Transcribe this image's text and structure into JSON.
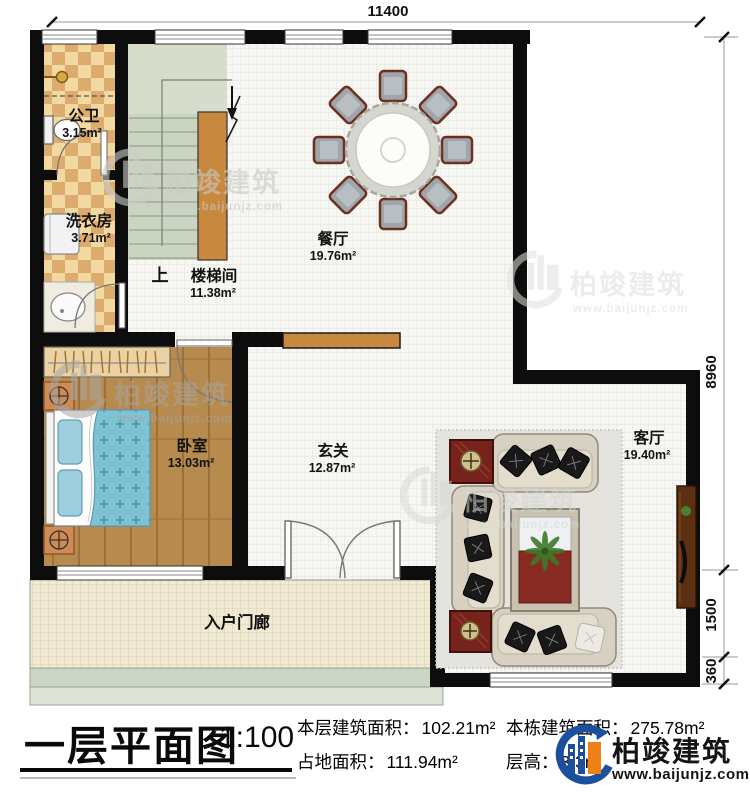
{
  "title_bar": {
    "plan_title": "一层平面图",
    "scale": "1:100",
    "stats": [
      {
        "label": "本层建筑面积：",
        "value": "102.21m²"
      },
      {
        "label": "占地面积：",
        "value": "111.94m²"
      },
      {
        "label": "本栋建筑面积：",
        "value": "275.78m²"
      },
      {
        "label": "层高：",
        "value": "3.3m"
      }
    ],
    "brand": {
      "name": "柏竣建筑",
      "url": "www.baijunjz.com"
    }
  },
  "rooms": [
    {
      "name": "公卫",
      "area": "3.15m²"
    },
    {
      "name": "洗衣房",
      "area": "3.71m²"
    },
    {
      "name": "楼梯间",
      "area": "11.38m²"
    },
    {
      "name": "餐厅",
      "area": "19.76m²"
    },
    {
      "name": "卧室",
      "area": "13.03m²"
    },
    {
      "name": "玄关",
      "area": "12.87m²"
    },
    {
      "name": "客厅",
      "area": "19.40m²"
    },
    {
      "name": "入户门廊",
      "area": ""
    }
  ],
  "stair": {
    "up_label": "上"
  },
  "dimensions": {
    "top_width": "11400",
    "right": [
      "8960",
      "1500",
      "360"
    ]
  },
  "watermark": {
    "name": "柏竣建筑",
    "url": "www.baijunjz.com"
  }
}
